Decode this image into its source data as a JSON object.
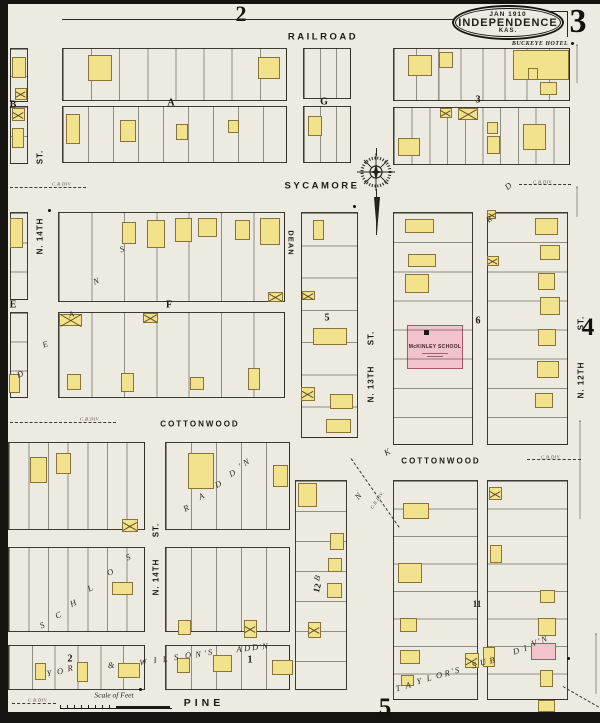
{
  "sheet": {
    "title_date": "JAN 1910",
    "title_city": "INDEPENDENCE",
    "title_state": "KAS.",
    "sheet_number": "3",
    "adjacent_top": "2",
    "adjacent_right": "4",
    "adjacent_bottom": "5"
  },
  "labels": {
    "buckeye_hotel": "BUCKEYE HOTEL",
    "school": "McKINLEY SCHOOL",
    "scale": "Scale of Feet",
    "boundary": "C.B.DIV."
  },
  "colors": {
    "paper": "#edeae1",
    "building_yellow": "#f1e28b",
    "building_pink": "#f3c3cd",
    "ink": "#24221c"
  },
  "street_labels": [
    [
      "RAILROAD",
      323,
      37,
      9.5,
      2.5,
      0
    ],
    [
      "SYCAMORE",
      322,
      186,
      9.5,
      2.5,
      0
    ],
    [
      "COTTONWOOD",
      200,
      424,
      8,
      2,
      0
    ],
    [
      "COTTONWOOD",
      441,
      461,
      8,
      2,
      0
    ],
    [
      "PINE",
      204,
      703,
      10.5,
      4,
      0
    ],
    [
      "DEAN",
      291,
      243,
      7.5,
      1,
      90
    ],
    [
      "ST.",
      40,
      157,
      8,
      1,
      -90
    ],
    [
      "N. 14TH",
      40,
      236,
      8,
      1,
      -90
    ],
    [
      "ST.",
      156,
      530,
      8,
      1,
      -90
    ],
    [
      "N. 14TH",
      156,
      577,
      8,
      1,
      -90
    ],
    [
      "ST.",
      371,
      338,
      8,
      1,
      -90
    ],
    [
      "N. 13TH",
      371,
      384,
      8,
      1,
      -90
    ],
    [
      "ST.",
      581,
      323,
      8,
      1,
      -90
    ],
    [
      "N. 12TH",
      581,
      380,
      8,
      1,
      -90
    ]
  ],
  "block_labels": [
    [
      "A",
      171,
      103,
      10,
      0
    ],
    [
      "B",
      13,
      105,
      10,
      0
    ],
    [
      "G",
      324,
      102,
      10,
      0
    ],
    [
      "3",
      478,
      100,
      10,
      0
    ],
    [
      "E",
      13,
      305,
      10,
      0
    ],
    [
      "F",
      169,
      305,
      10,
      0
    ],
    [
      "5",
      327,
      318,
      10,
      0
    ],
    [
      "6",
      478,
      321,
      10,
      0
    ],
    [
      "11",
      477,
      604,
      9,
      0
    ],
    [
      "12",
      317,
      588,
      9,
      -75
    ],
    [
      "1",
      250,
      660,
      10,
      0
    ],
    [
      "2",
      70,
      659,
      10,
      0
    ]
  ],
  "blocks": [
    [
      10,
      48,
      18,
      54,
      2,
      "h"
    ],
    [
      10,
      106,
      18,
      58,
      2,
      "h"
    ],
    [
      62,
      48,
      225,
      53,
      8,
      "v"
    ],
    [
      303,
      48,
      48,
      51,
      3,
      "v"
    ],
    [
      393,
      48,
      177,
      53,
      8,
      "v"
    ],
    [
      62,
      106,
      225,
      57,
      9,
      "v"
    ],
    [
      303,
      106,
      48,
      57,
      3,
      "v"
    ],
    [
      393,
      107,
      177,
      58,
      10,
      "v"
    ],
    [
      10,
      212,
      18,
      88,
      3,
      "h"
    ],
    [
      10,
      312,
      18,
      86,
      3,
      "h"
    ],
    [
      58,
      212,
      227,
      90,
      7,
      "v"
    ],
    [
      58,
      312,
      227,
      86,
      7,
      "v"
    ],
    [
      301,
      212,
      57,
      226,
      7,
      "h"
    ],
    [
      393,
      212,
      80,
      233,
      8,
      "h"
    ],
    [
      487,
      212,
      81,
      233,
      8,
      "h"
    ],
    [
      295,
      480,
      52,
      210,
      7,
      "h"
    ],
    [
      8,
      442,
      137,
      88,
      7,
      "v"
    ],
    [
      165,
      442,
      125,
      88,
      5,
      "v"
    ],
    [
      8,
      547,
      137,
      85,
      7,
      "v"
    ],
    [
      165,
      547,
      125,
      85,
      5,
      "v"
    ],
    [
      8,
      645,
      137,
      45,
      6,
      "v"
    ],
    [
      165,
      645,
      125,
      45,
      5,
      "v"
    ],
    [
      393,
      480,
      85,
      220,
      8,
      "h"
    ],
    [
      487,
      480,
      81,
      220,
      8,
      "h"
    ]
  ],
  "buildings": [
    [
      12,
      57,
      14,
      21,
      "y"
    ],
    [
      15,
      88,
      12,
      12,
      "yx"
    ],
    [
      88,
      55,
      24,
      26,
      "y"
    ],
    [
      258,
      57,
      22,
      22,
      "y"
    ],
    [
      408,
      55,
      24,
      21,
      "y"
    ],
    [
      439,
      52,
      14,
      16,
      "y"
    ],
    [
      513,
      50,
      56,
      30,
      "y"
    ],
    [
      528,
      68,
      10,
      12,
      "y"
    ],
    [
      540,
      82,
      17,
      13,
      "y"
    ],
    [
      12,
      108,
      13,
      13,
      "yx"
    ],
    [
      12,
      128,
      12,
      20,
      "y"
    ],
    [
      66,
      114,
      14,
      30,
      "y"
    ],
    [
      120,
      120,
      16,
      22,
      "y"
    ],
    [
      176,
      124,
      12,
      16,
      "y"
    ],
    [
      228,
      120,
      11,
      13,
      "y"
    ],
    [
      308,
      116,
      14,
      20,
      "y"
    ],
    [
      398,
      138,
      22,
      18,
      "y"
    ],
    [
      440,
      108,
      12,
      10,
      "yx"
    ],
    [
      458,
      108,
      20,
      12,
      "yx"
    ],
    [
      487,
      122,
      11,
      12,
      "y"
    ],
    [
      487,
      136,
      13,
      18,
      "y"
    ],
    [
      523,
      124,
      23,
      26,
      "y"
    ],
    [
      122,
      222,
      14,
      22,
      "y"
    ],
    [
      147,
      220,
      18,
      28,
      "y"
    ],
    [
      175,
      218,
      17,
      24,
      "y"
    ],
    [
      198,
      218,
      19,
      19,
      "y"
    ],
    [
      235,
      220,
      15,
      20,
      "y"
    ],
    [
      260,
      218,
      20,
      27,
      "y"
    ],
    [
      268,
      292,
      15,
      10,
      "yx"
    ],
    [
      59,
      314,
      23,
      12,
      "yx"
    ],
    [
      143,
      313,
      15,
      10,
      "yx"
    ],
    [
      67,
      374,
      14,
      16,
      "y"
    ],
    [
      121,
      373,
      13,
      19,
      "y"
    ],
    [
      190,
      377,
      14,
      13,
      "y"
    ],
    [
      248,
      368,
      12,
      22,
      "y"
    ],
    [
      10,
      218,
      13,
      30,
      "y"
    ],
    [
      9,
      374,
      11,
      19,
      "y"
    ],
    [
      313,
      220,
      11,
      20,
      "y"
    ],
    [
      302,
      291,
      13,
      9,
      "yx"
    ],
    [
      313,
      328,
      34,
      17,
      "y"
    ],
    [
      301,
      387,
      14,
      14,
      "yx"
    ],
    [
      330,
      394,
      23,
      15,
      "y"
    ],
    [
      326,
      419,
      25,
      14,
      "y"
    ],
    [
      405,
      219,
      29,
      14,
      "y"
    ],
    [
      408,
      254,
      28,
      13,
      "y"
    ],
    [
      405,
      274,
      24,
      19,
      "y"
    ],
    [
      487,
      210,
      9,
      9,
      "yx"
    ],
    [
      487,
      256,
      12,
      10,
      "yx"
    ],
    [
      535,
      218,
      23,
      17,
      "y"
    ],
    [
      540,
      245,
      20,
      15,
      "y"
    ],
    [
      538,
      273,
      17,
      17,
      "y"
    ],
    [
      540,
      297,
      20,
      18,
      "y"
    ],
    [
      538,
      329,
      18,
      17,
      "y"
    ],
    [
      537,
      361,
      22,
      17,
      "y"
    ],
    [
      535,
      393,
      18,
      15,
      "y"
    ],
    [
      30,
      457,
      17,
      26,
      "y"
    ],
    [
      56,
      453,
      15,
      21,
      "y"
    ],
    [
      122,
      519,
      16,
      13,
      "yx"
    ],
    [
      188,
      453,
      26,
      36,
      "y"
    ],
    [
      273,
      465,
      15,
      22,
      "y"
    ],
    [
      112,
      582,
      21,
      13,
      "y"
    ],
    [
      178,
      620,
      13,
      15,
      "y"
    ],
    [
      244,
      620,
      13,
      18,
      "yx"
    ],
    [
      35,
      663,
      11,
      17,
      "y"
    ],
    [
      77,
      662,
      11,
      20,
      "y"
    ],
    [
      118,
      663,
      22,
      15,
      "y"
    ],
    [
      177,
      658,
      13,
      15,
      "y"
    ],
    [
      213,
      655,
      19,
      17,
      "y"
    ],
    [
      272,
      660,
      21,
      15,
      "y"
    ],
    [
      298,
      483,
      19,
      24,
      "y"
    ],
    [
      330,
      533,
      14,
      17,
      "y"
    ],
    [
      328,
      558,
      14,
      14,
      "y"
    ],
    [
      327,
      583,
      15,
      15,
      "y"
    ],
    [
      308,
      622,
      13,
      16,
      "yx"
    ],
    [
      403,
      503,
      26,
      16,
      "y"
    ],
    [
      398,
      563,
      24,
      20,
      "y"
    ],
    [
      400,
      618,
      17,
      14,
      "y"
    ],
    [
      400,
      650,
      20,
      14,
      "y"
    ],
    [
      401,
      675,
      13,
      11,
      "y"
    ],
    [
      465,
      653,
      14,
      15,
      "yx"
    ],
    [
      483,
      647,
      12,
      20,
      "y"
    ],
    [
      489,
      487,
      13,
      13,
      "yx"
    ],
    [
      490,
      545,
      12,
      18,
      "y"
    ],
    [
      540,
      590,
      15,
      13,
      "y"
    ],
    [
      538,
      618,
      18,
      18,
      "y"
    ],
    [
      531,
      643,
      25,
      17,
      "p"
    ],
    [
      540,
      670,
      13,
      17,
      "y"
    ],
    [
      538,
      700,
      17,
      12,
      "y"
    ]
  ],
  "letters": [
    [
      "D",
      20,
      374,
      -20
    ],
    [
      "E",
      45,
      344,
      -20
    ],
    [
      "A",
      71,
      314,
      -20
    ],
    [
      "N",
      96,
      281,
      -20
    ],
    [
      "S",
      122,
      249,
      -20
    ],
    [
      "S",
      42,
      625,
      -25
    ],
    [
      "C",
      58,
      615,
      -25
    ],
    [
      "H",
      73,
      603,
      -25
    ],
    [
      "L",
      90,
      588,
      -25
    ],
    [
      "O",
      110,
      572,
      -25
    ],
    [
      "S",
      128,
      557,
      -25
    ],
    [
      "R",
      186,
      508,
      -28
    ],
    [
      "A",
      201,
      496,
      -28
    ],
    [
      "D",
      218,
      484,
      -28
    ],
    [
      "D",
      232,
      473,
      -28
    ],
    [
      "'",
      240,
      466,
      -28
    ],
    [
      "N",
      246,
      462,
      -28
    ],
    [
      "W",
      143,
      662,
      -8
    ],
    [
      "I",
      155,
      660,
      -8
    ],
    [
      "L",
      165,
      659,
      -8
    ],
    [
      "S",
      176,
      657,
      -8
    ],
    [
      "O",
      188,
      655,
      -8
    ],
    [
      "N",
      198,
      654,
      -8
    ],
    [
      "'",
      205,
      653,
      -8
    ],
    [
      "S",
      210,
      652,
      -8
    ],
    [
      "A",
      239,
      649,
      -5
    ],
    [
      "D",
      247,
      648,
      -5
    ],
    [
      "D",
      255,
      647,
      -5
    ],
    [
      "'",
      260,
      647,
      -5
    ],
    [
      "N",
      265,
      646,
      -5
    ],
    [
      "Y",
      49,
      673,
      -10
    ],
    [
      "O",
      60,
      671,
      -10
    ],
    [
      "R",
      70,
      668,
      -10
    ],
    [
      "&",
      111,
      665,
      -10
    ],
    [
      "T",
      398,
      688,
      -12
    ],
    [
      "A",
      408,
      685,
      -12
    ],
    [
      "Y",
      419,
      681,
      -12
    ],
    [
      "L",
      429,
      678,
      -12
    ],
    [
      "O",
      439,
      675,
      -12
    ],
    [
      "R",
      447,
      673,
      -12
    ],
    [
      "'",
      452,
      671,
      -12
    ],
    [
      "S",
      457,
      670,
      -12
    ],
    [
      "S",
      474,
      665,
      -15
    ],
    [
      "U",
      483,
      662,
      -15
    ],
    [
      "B",
      492,
      660,
      -15
    ],
    [
      "D",
      516,
      651,
      -18
    ],
    [
      "I",
      525,
      648,
      -18
    ],
    [
      "V",
      534,
      643,
      -18
    ],
    [
      "'",
      539,
      641,
      -18
    ],
    [
      "N",
      544,
      639,
      -18
    ],
    [
      "D",
      508,
      186,
      -40
    ],
    [
      "R",
      489,
      219,
      -40
    ],
    [
      "N",
      358,
      496,
      -50
    ],
    [
      "K",
      387,
      452,
      -30
    ],
    [
      "B",
      317,
      578,
      -70
    ]
  ],
  "boundary_positions": [
    [
      62,
      184,
      0
    ],
    [
      543,
      182,
      0
    ],
    [
      90,
      419,
      0
    ],
    [
      551,
      457,
      0
    ],
    [
      38,
      700,
      0
    ],
    [
      377,
      500,
      -55
    ]
  ],
  "dashes": [
    [
      10,
      187,
      76,
      0,
      "a"
    ],
    [
      10,
      422,
      106,
      0,
      "a"
    ],
    [
      12,
      703,
      44,
      0,
      "a"
    ],
    [
      527,
      459,
      54,
      0,
      "a"
    ],
    [
      519,
      184,
      52,
      0,
      "a"
    ],
    [
      577,
      44,
      38,
      90,
      "o"
    ],
    [
      577,
      186,
      30,
      90,
      "o"
    ],
    [
      580,
      420,
      98,
      90,
      "o"
    ],
    [
      596,
      633,
      60,
      90,
      "o"
    ],
    [
      351,
      458,
      84,
      55,
      "a"
    ],
    [
      563,
      686,
      46,
      30,
      "a"
    ]
  ],
  "rules": [
    [
      62,
      19,
      391,
      0
    ],
    [
      548,
      11,
      20,
      0
    ],
    [
      568,
      11,
      26,
      90
    ],
    [
      377,
      148,
      8,
      90
    ],
    [
      377,
      189,
      46,
      90
    ]
  ],
  "dots": [
    [
      49,
      210
    ],
    [
      354,
      206
    ],
    [
      140,
      689
    ],
    [
      568,
      658
    ],
    [
      572,
      43
    ]
  ]
}
